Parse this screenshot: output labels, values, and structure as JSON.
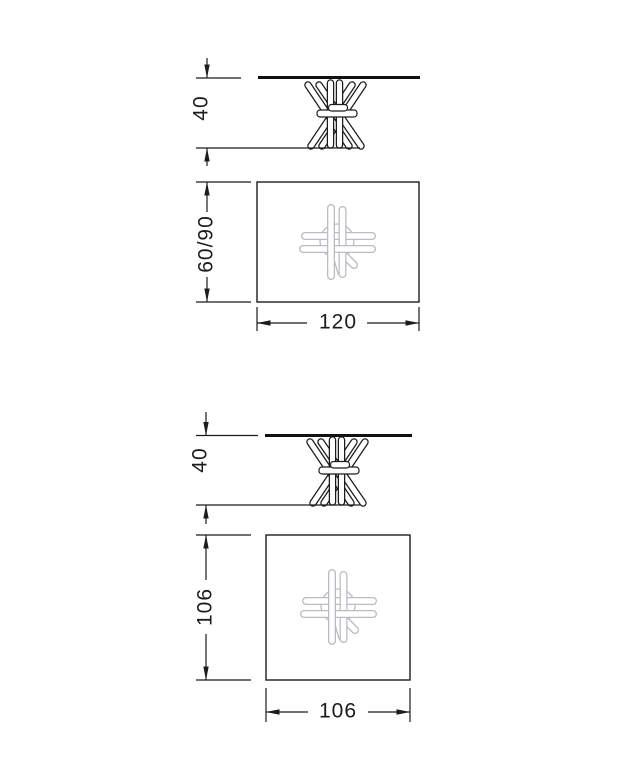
{
  "page": {
    "background_color": "#ffffff",
    "line_color": "#1c1c1c",
    "legs_light_color": "#b9bdc1"
  },
  "drawings": [
    {
      "name": "rectangular-table-120",
      "elevation": {
        "height_dim": "40"
      },
      "plan": {
        "depth_dim": "60/90",
        "width_dim": "120"
      }
    },
    {
      "name": "square-table-106",
      "elevation": {
        "height_dim": "40"
      },
      "plan": {
        "depth_dim": "106",
        "width_dim": "106"
      }
    }
  ]
}
